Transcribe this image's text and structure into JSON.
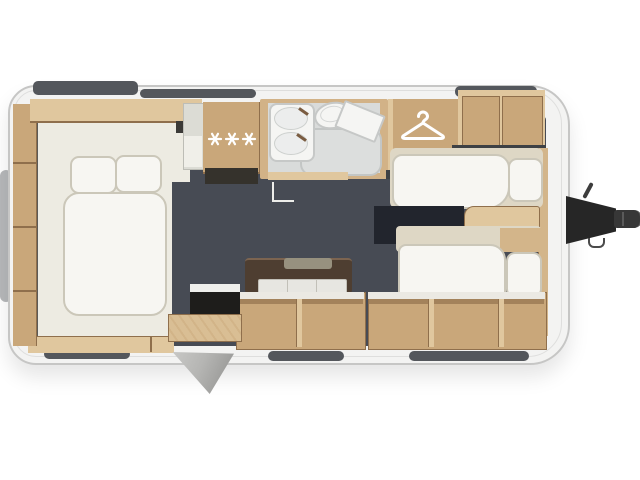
{
  "scene": {
    "description": "caravan floor plan, top-down cutaway render, no text labels",
    "areas": {
      "rear_bedroom": {
        "bed": "double",
        "pillow_count": 2,
        "side_shelf_compartments": 4
      },
      "kitchen": {
        "burner_count": 3
      },
      "washroom": {
        "fixtures": [
          "washbasin",
          "toilet",
          "shower-tray",
          "corner-shelf"
        ]
      },
      "wardrobe": {
        "hanger_count": 1
      },
      "front_lounge": {
        "bench_count": 2,
        "storage_compartments": 5
      },
      "entry": {
        "door_state": "open",
        "step": true
      },
      "tow_hitch": {
        "position": "front-right"
      }
    },
    "icons": {
      "burner": "gas-burner-star",
      "hanger": "clothes-hanger"
    }
  },
  "colors": {
    "bg": "#ffffff",
    "shell": "#f3f3f2",
    "shell-border": "#c6c6c5",
    "shell-inner": "#dededd",
    "window": "#54575c",
    "glass-rear": "#b6b8ba",
    "floor": "#474b54",
    "bedroom": "#edebe2",
    "line-dark": "#5b5a57",
    "wood": "#d3b58a",
    "wood-light": "#e0c79e",
    "wood-mid": "#c9a77a",
    "wood-dark": "#a8865e",
    "wood-edge": "#8f6f4c",
    "white-f": "#f7f6f2",
    "white-border": "#cbc7b9",
    "cream-base": "#ded7c5",
    "bath-wall": "#d2b287",
    "bath-floor": "#d9dbda",
    "fixture": "#f5f5f3",
    "fixture-border": "#c6c8c7",
    "counter-dark": "#3e4145",
    "table": "#4e3e31",
    "table-top": "#97917f",
    "navy": "#22252d",
    "black": "#1e1d1b",
    "door-grey": "#b5b5b3",
    "hitch": "#262626"
  }
}
